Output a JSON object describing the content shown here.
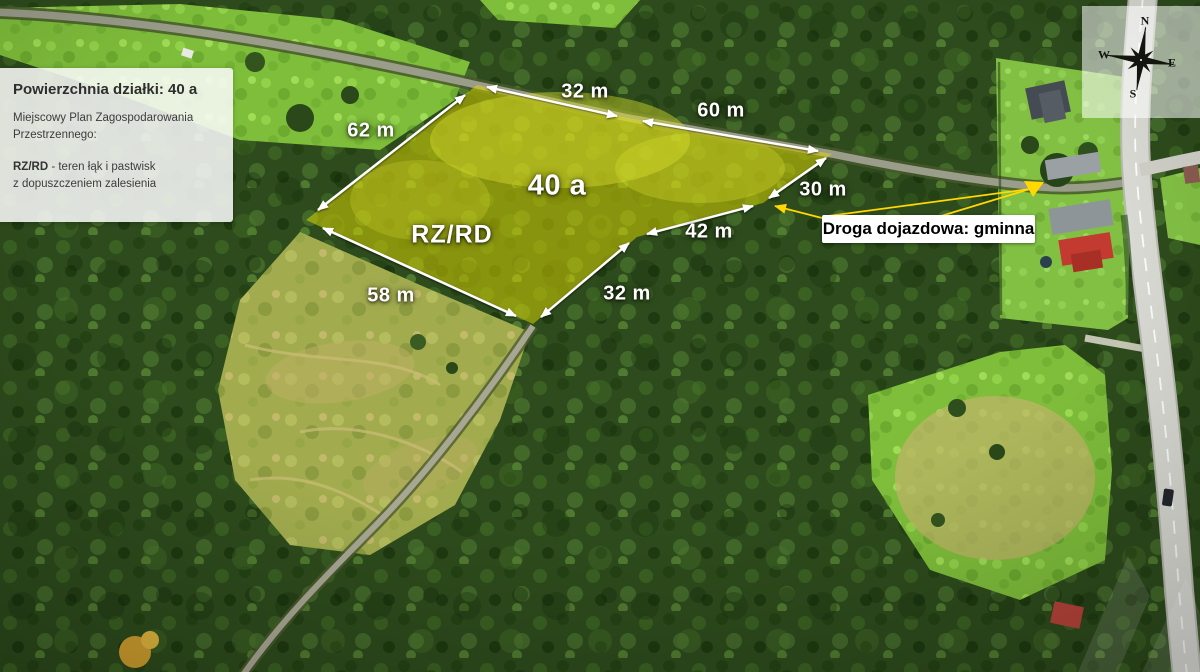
{
  "info_panel": {
    "title": "Powierzchnia działki: 40 a",
    "plan_label": "Miejscowy Plan Zagospodarowania Przestrzennego:",
    "zone_code": "RZ/RD",
    "zone_desc_line1": " -  teren łąk i pastwisk",
    "zone_desc_line2": "z dopuszczeniem zalesienia"
  },
  "access_road": {
    "label": "Droga dojazdowa: gminna"
  },
  "parcel": {
    "area_label": "40 a",
    "zone_label": "RZ/RD",
    "edge_lengths_m": [
      32,
      60,
      30,
      42,
      32,
      58,
      62
    ],
    "highlight_color": "#e4dc00"
  },
  "overlay_labels": [
    {
      "name": "dim-top-32",
      "text": "32 m",
      "x": 585,
      "y": 92,
      "cls": "dim"
    },
    {
      "name": "dim-60",
      "text": "60 m",
      "x": 721,
      "y": 111,
      "cls": "dim"
    },
    {
      "name": "dim-30",
      "text": "30 m",
      "x": 823,
      "y": 190,
      "cls": "dim"
    },
    {
      "name": "dim-42",
      "text": "42 m",
      "x": 709,
      "y": 232,
      "cls": "dim"
    },
    {
      "name": "dim-bottom-32",
      "text": "32 m",
      "x": 627,
      "y": 294,
      "cls": "dim"
    },
    {
      "name": "dim-58",
      "text": "58 m",
      "x": 391,
      "y": 296,
      "cls": "dim"
    },
    {
      "name": "dim-62",
      "text": "62 m",
      "x": 371,
      "y": 131,
      "cls": "dim"
    },
    {
      "name": "area-label",
      "text": "40 a",
      "x": 557,
      "y": 186,
      "cls": "area"
    },
    {
      "name": "zone-label",
      "text": "RZ/RD",
      "x": 452,
      "y": 235,
      "cls": "zone"
    }
  ],
  "compass": {
    "letters": [
      {
        "name": "compass-letter-n",
        "text": "N",
        "x": 63,
        "y": 15
      },
      {
        "name": "compass-letter-e",
        "text": "E",
        "x": 90,
        "y": 57
      },
      {
        "name": "compass-letter-s",
        "text": "S",
        "x": 51,
        "y": 88
      },
      {
        "name": "compass-letter-w",
        "text": "W",
        "x": 22,
        "y": 49
      }
    ]
  },
  "colors": {
    "parcel_fill": "#e4dc00",
    "callout_yellow": "#ffd900",
    "dimension_text": "#ffffff",
    "panel_bg": "rgba(251,251,251,0.86)"
  }
}
